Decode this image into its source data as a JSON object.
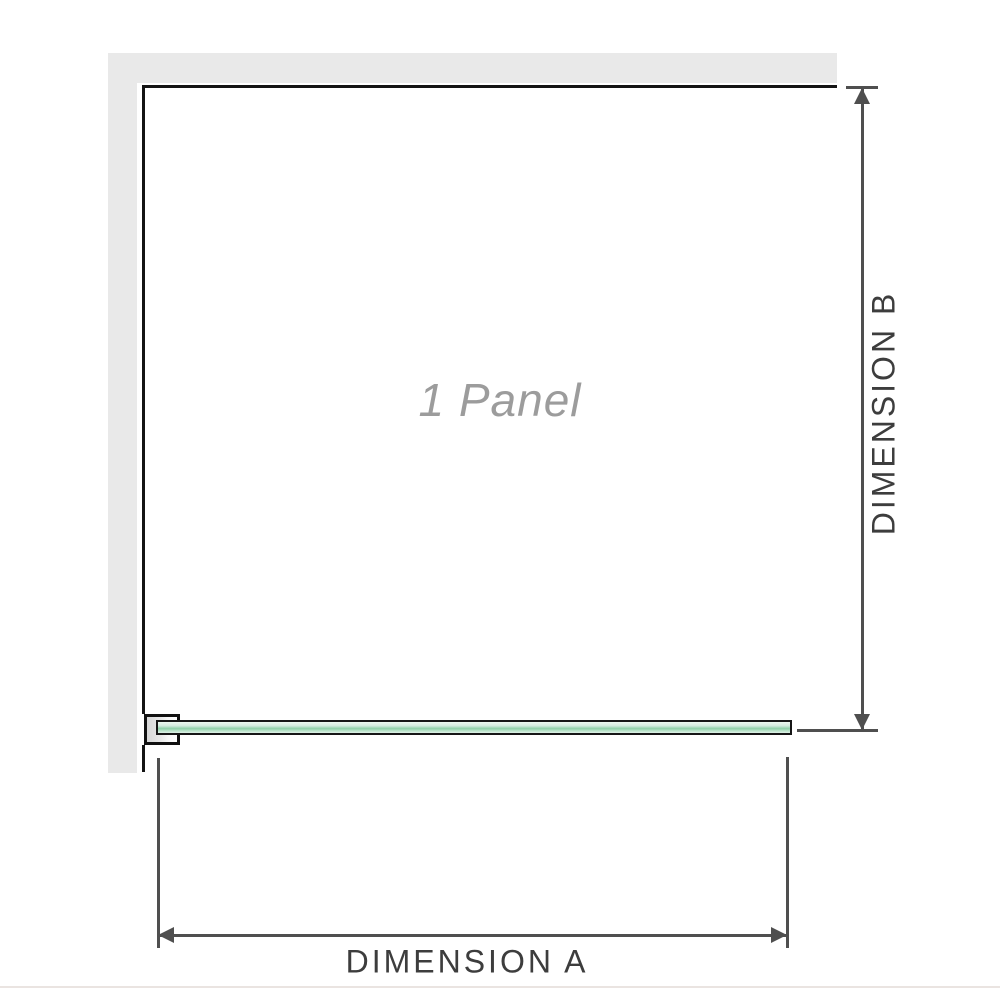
{
  "diagram": {
    "panel_label": "1 Panel",
    "dimension_a": {
      "label": "DIMENSION A",
      "orientation": "horizontal"
    },
    "dimension_b": {
      "label": "DIMENSION B",
      "orientation": "vertical"
    }
  },
  "icons": [
    {
      "name": "arrow-up-icon",
      "meaning": "dimension B upper arrowhead"
    },
    {
      "name": "arrow-down-icon",
      "meaning": "dimension B lower arrowhead"
    },
    {
      "name": "arrow-left-icon",
      "meaning": "dimension A left arrowhead"
    },
    {
      "name": "arrow-right-icon",
      "meaning": "dimension A right arrowhead"
    }
  ],
  "colors": {
    "background": "#ffffff",
    "wall_fill": "#e9e9e9",
    "enclosure_outline": "#141414",
    "dimension_line": "#4f4f4f",
    "dimension_text": "#3d3d3d",
    "panel_label_text": "#9c9c9c",
    "glass_light_green": "#d2ebdd",
    "glass_mid_green": "#8ecfa8",
    "bracket_fill": "#e6e6e6",
    "baseline_rule": "#eae4e1"
  }
}
